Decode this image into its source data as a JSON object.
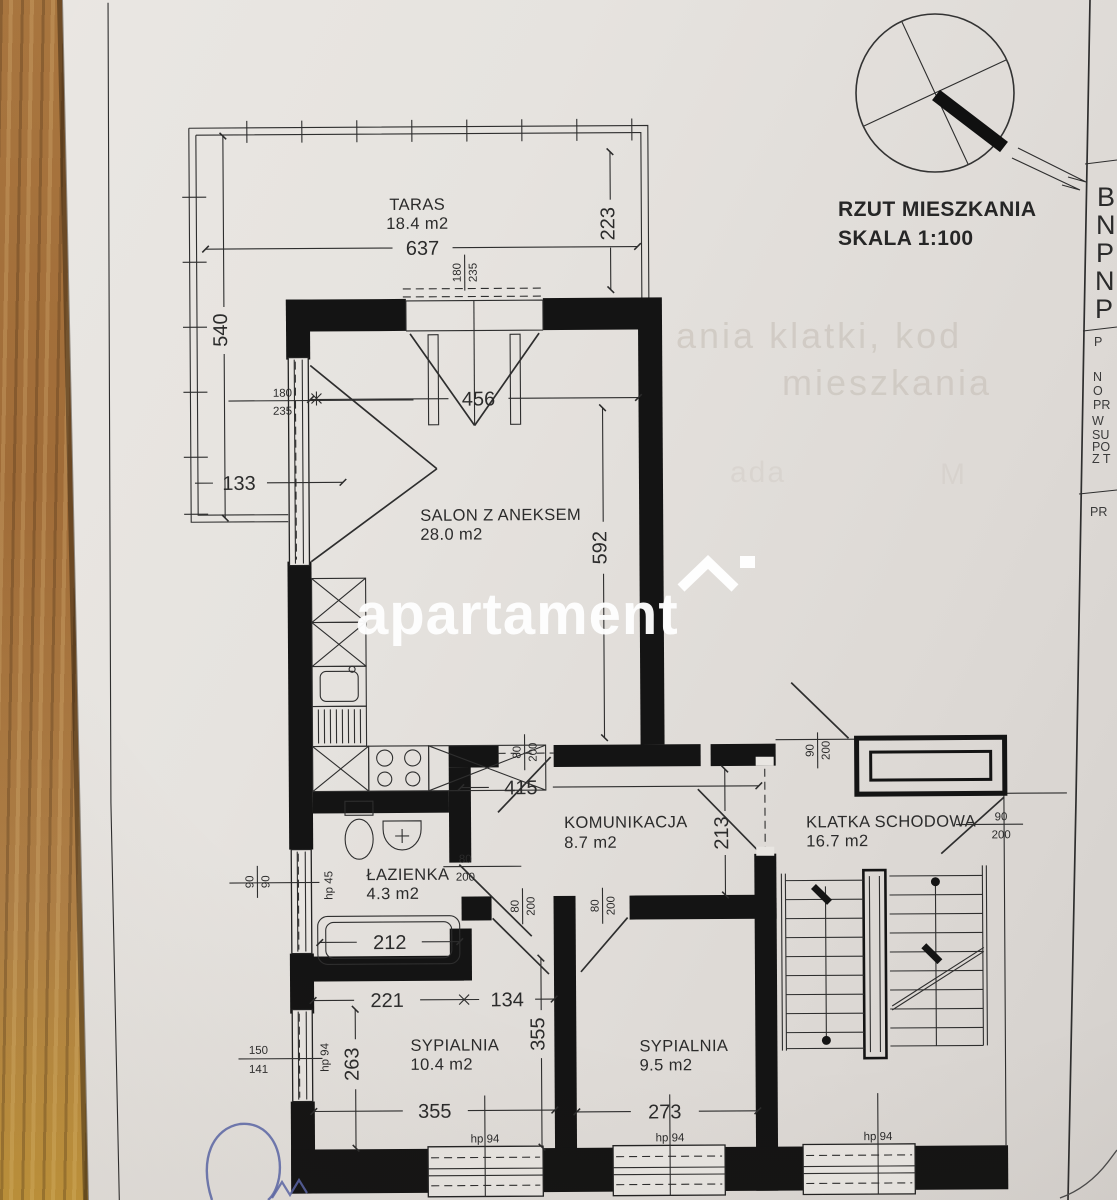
{
  "header": {
    "title": "RZUT MIESZKANIA",
    "scale": "SKALA 1:100"
  },
  "watermark": {
    "text": "apartament"
  },
  "ghost_text": {
    "line1": "ania klatki, kod",
    "line2": "mieszkania",
    "line3a": "ada",
    "line3b": "M"
  },
  "title_block": {
    "large_fragments": [
      "B",
      "N",
      "P",
      "N",
      "P"
    ],
    "small_fragments": [
      "P",
      "N",
      "O",
      "PR",
      "W",
      "SU",
      "PO",
      "Z T"
    ],
    "bottom_fragment": "PR"
  },
  "rooms": {
    "taras": {
      "name": "TARAS",
      "area": "18.4 m2"
    },
    "salon": {
      "name": "SALON Z ANEKSEM",
      "area": "28.0 m2"
    },
    "komunikacja": {
      "name": "KOMUNIKACJA",
      "area": "8.7 m2"
    },
    "klatka": {
      "name": "KLATKA SCHODOWA",
      "area": "16.7 m2"
    },
    "lazienka": {
      "name": "ŁAZIENKA",
      "area": "4.3 m2"
    },
    "sypialnia1": {
      "name": "SYPIALNIA",
      "area": "10.4 m2"
    },
    "sypialnia2": {
      "name": "SYPIALNIA",
      "area": "9.5 m2"
    }
  },
  "dimensions": {
    "taras_width": "637",
    "taras_depth": "223",
    "taras_side": "540",
    "taras_edge": "133",
    "salon_width": "456",
    "salon_length": "592",
    "hall_width": "415",
    "hall_depth": "213",
    "bath_width": "212",
    "bed1_top_a": "221",
    "bed1_top_b": "134",
    "bed1_side": "263",
    "bed_mid": "355",
    "bed1_width": "355",
    "bed2_width": "273"
  },
  "openings": {
    "balcony_door": {
      "w": "180",
      "h": "235"
    },
    "salon_window": {
      "w": "180",
      "h": "235"
    },
    "salon_hall_door": {
      "w": "80",
      "h": "200"
    },
    "bath_door": {
      "w": "80",
      "h": "200"
    },
    "bed1_door": {
      "w": "80",
      "h": "200"
    },
    "bed2_door": {
      "w": "80",
      "h": "200"
    },
    "stair_top_door": {
      "w": "90",
      "h": "200"
    },
    "stair_right_door": {
      "w": "90",
      "h": "200"
    },
    "bath_window": {
      "w": "90",
      "h": "90"
    },
    "bed1_side_window": {
      "w": "150",
      "h": "141"
    }
  },
  "sills": {
    "bath": "hp 45",
    "bed1_side": "hp 94",
    "bed1": "hp 94",
    "bed2": "hp 94",
    "stair": "hp 94"
  }
}
